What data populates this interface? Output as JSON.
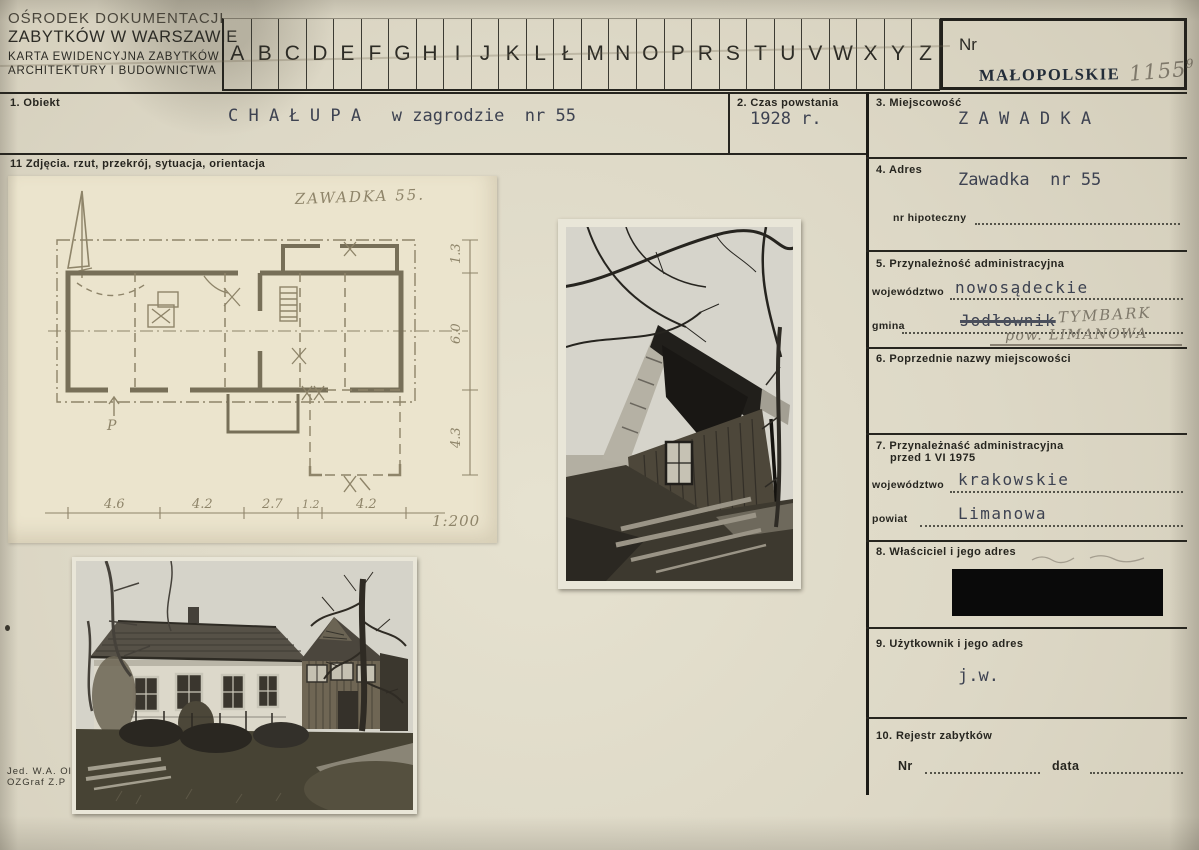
{
  "header": {
    "org_line1": "OŚRODEK DOKUMENTACJI",
    "org_line2": "ZABYTKÓW W WARSZAWIE",
    "org_line3": "KARTA EWIDENCYJNA ZABYTKÓW",
    "org_line4": "ARCHITEKTURY I BUDOWNICTWA",
    "alphabet": [
      "A",
      "B",
      "C",
      "D",
      "E",
      "F",
      "G",
      "H",
      "I",
      "J",
      "K",
      "L",
      "Ł",
      "M",
      "N",
      "O",
      "P",
      "R",
      "S",
      "T",
      "U",
      "V",
      "W",
      "X",
      "Y",
      "Z"
    ],
    "nr_label": "Nr",
    "voivodeship_stamp": "MAŁOPOLSKIE",
    "inventory_number": "1155",
    "inventory_number_suffix": "9"
  },
  "fields": {
    "object": {
      "label": "1. Obiekt",
      "value": "C H A Ł U P A   w zagrodzie  nr 55"
    },
    "czas": {
      "label": "2. Czas powstania",
      "value": "1928 r."
    },
    "miejscowosc": {
      "label": "3. Miejscowość",
      "value": "Z A W A D K A"
    },
    "adres": {
      "label": "4. Adres",
      "value": "Zawadka  nr 55",
      "hipoteczny_label": "nr hipoteczny"
    },
    "przynaleznosc": {
      "label": "5. Przynależność administracyjna",
      "woj_label": "województwo",
      "woj_value": "nowosądeckie",
      "gmina_label": "gmina",
      "gmina_typed": "Jodłownik",
      "gmina_hand": "TYMBARK",
      "gmina_hand2": "pow. LIMANOWA"
    },
    "poprzednie": {
      "label": "6. Poprzednie nazwy miejscowości"
    },
    "przyn1975": {
      "label": "7. Przynależnaść administracyjna",
      "label2": "przed 1 VI 1975",
      "woj_label": "województwo",
      "woj_value": "krakowskie",
      "powiat_label": "powiat",
      "powiat_value": "Limanowa"
    },
    "wlasciciel": {
      "label": "8. Właściciel i jego adres"
    },
    "uzytkownik": {
      "label": "9. Użytkownik i jego adres",
      "value": "j.w."
    },
    "rejestr": {
      "label": "10. Rejestr zabytków",
      "nr_label": "Nr",
      "data_label": "data"
    },
    "zdjecia": {
      "label": "11  Zdjęcia. rzut, przekrój, sytuacja, orientacja"
    }
  },
  "plan": {
    "title": "ZAWADKA 55.",
    "scale": "1:200",
    "right_dims": [
      "1.3",
      "6.0",
      "4.3"
    ],
    "bottom_dims": [
      "4.6",
      "4.2",
      "2.7",
      "1.2",
      "4.2"
    ],
    "entrance_label": "P"
  },
  "imprint": {
    "line1": "Jed. W.A. Ol",
    "line2": "OZGraf Z.P"
  },
  "colors": {
    "paper": "#ddd8c6",
    "plan_paper": "#ebe4cd",
    "ink": "#26251f",
    "typed_ink": "#3d4251",
    "stamp_ink": "#222c38",
    "pencil": "#8e8469",
    "redaction": "#0a0a0a"
  }
}
